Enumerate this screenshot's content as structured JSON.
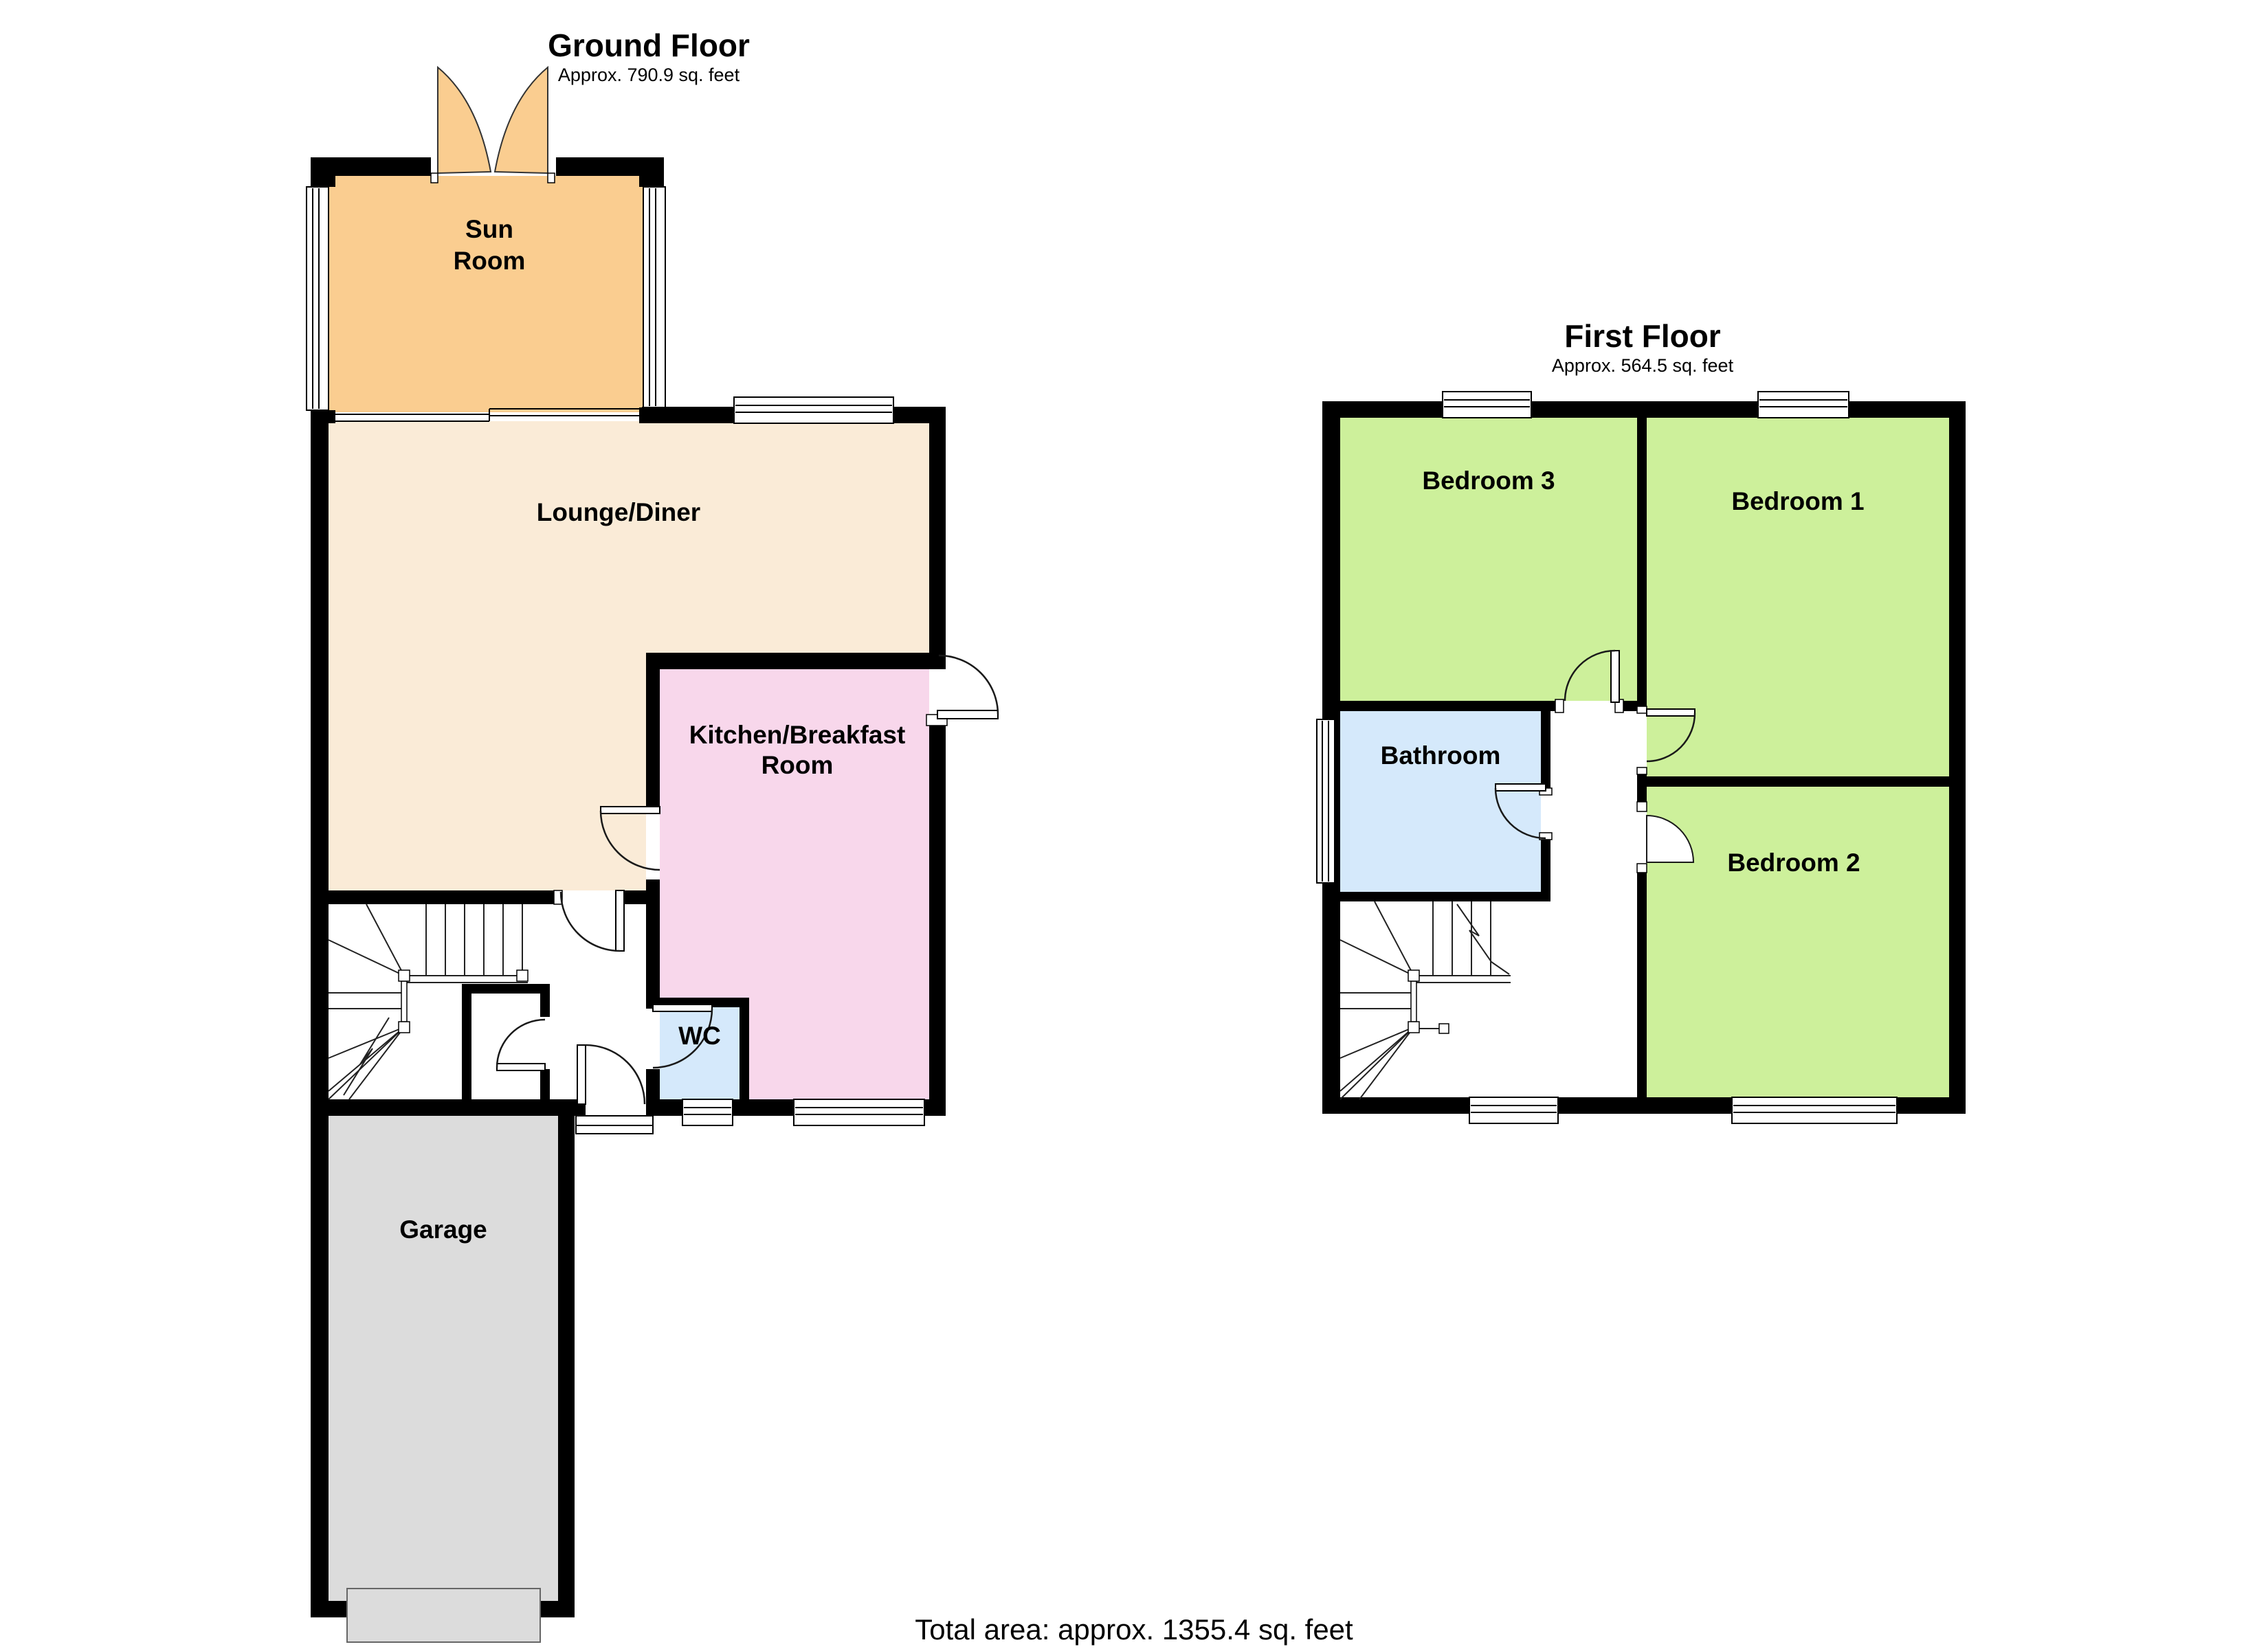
{
  "page": {
    "background": "#ffffff",
    "total_area": "Total area: approx. 1355.4 sq. feet"
  },
  "palette": {
    "wall": "#000000",
    "sun_room": "#FACD90",
    "lounge": "#FAEBD7",
    "kitchen": "#F8D7EB",
    "wc": "#D5E9FB",
    "bathroom": "#D5E9FB",
    "bedroom": "#CDF09B",
    "garage": "#DCDCDC",
    "garage_door": "#DCDCDC"
  },
  "floors": [
    {
      "id": "ground-floor",
      "title": "Ground Floor",
      "area": "Approx. 790.9 sq. feet",
      "rooms": [
        {
          "id": "sun-room",
          "label": "Sun Room",
          "lines": [
            "Sun",
            "Room"
          ]
        },
        {
          "id": "lounge-diner",
          "label": "Lounge/Diner",
          "lines": [
            "Lounge/Diner"
          ]
        },
        {
          "id": "kitchen-breakfast-room",
          "label": "Kitchen/Breakfast Room",
          "lines": [
            "Kitchen/Breakfast",
            "Room"
          ]
        },
        {
          "id": "wc",
          "label": "WC",
          "lines": [
            "WC"
          ]
        },
        {
          "id": "garage",
          "label": "Garage",
          "lines": [
            "Garage"
          ]
        }
      ]
    },
    {
      "id": "first-floor",
      "title": "First Floor",
      "area": "Approx. 564.5 sq. feet",
      "rooms": [
        {
          "id": "bedroom-3",
          "label": "Bedroom 3",
          "lines": [
            "Bedroom 3"
          ]
        },
        {
          "id": "bedroom-1",
          "label": "Bedroom 1",
          "lines": [
            "Bedroom 1"
          ]
        },
        {
          "id": "bathroom",
          "label": "Bathroom",
          "lines": [
            "Bathroom"
          ]
        },
        {
          "id": "bedroom-2",
          "label": "Bedroom 2",
          "lines": [
            "Bedroom 2"
          ]
        }
      ]
    }
  ]
}
